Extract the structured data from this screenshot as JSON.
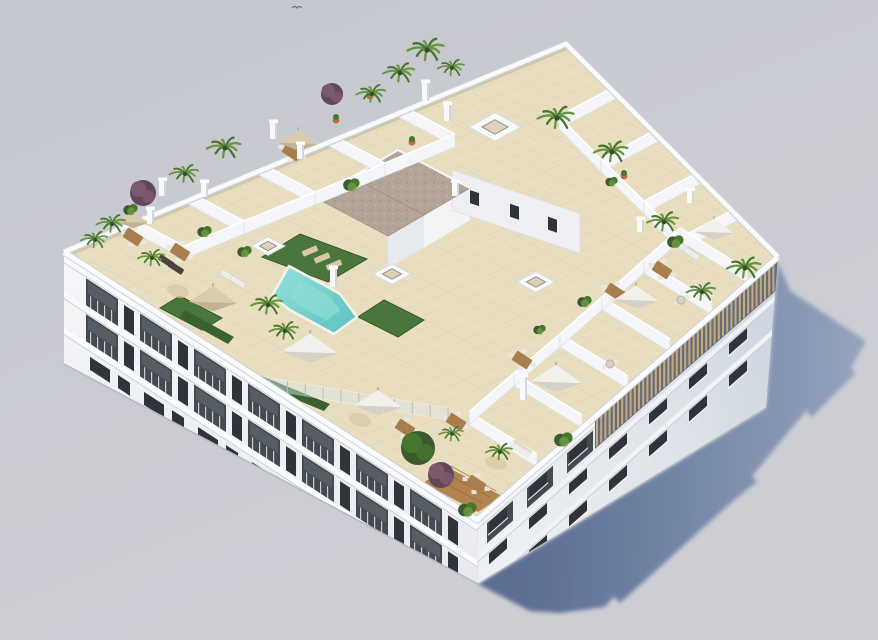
{
  "meta": {
    "alt": "Aerial 3D architectural rendering of a white apartment block with rooftop terraces, swimming pool, palm trees and parasols"
  },
  "palette": {
    "bg1": "#c5c7cf",
    "bg2": "#cdced4",
    "shadow1": "#57698f",
    "shadow2": "#7285a7",
    "shadow3": "#96a4bd",
    "facadeL1": "#f5f6f8",
    "facadeL2": "#e8eaee",
    "facadeR1": "#edeff2",
    "facadeR2": "#dde2e8",
    "facadeR3": "#ccd4de",
    "parapet": "#f9fafb",
    "parapetLine": "#ced2d8",
    "slab": "#fafbfd",
    "slabEdge": "#ced3d9",
    "windowDark": "#30343a",
    "balconyDark": "#454a52",
    "glassHint": "#5a6069",
    "mullion": "#c9ccd2",
    "roofTile": "#e9dec0",
    "tileLine": "rgba(120,100,60,0.18)",
    "pool1": "#5cc4c0",
    "pool2": "#8cdcd6",
    "poolEdge": "#f6f3ea",
    "lawn": "#49763a",
    "lawnStroke": "#35582b",
    "hedge": "#3a6130",
    "gravel": "#b2a597",
    "gravelDotA": "#a2958a",
    "gravelDotB": "#bfb3a6",
    "coreFace1": "#f1f3f5",
    "coreFace2": "#e6e9ed",
    "coreEdge": "#9a9084",
    "pergolaDark": "#59636f",
    "slat": "#c7a97e",
    "wood": "#a87e4e",
    "woodDeck": "#b08350",
    "plank": "#8a6238",
    "sofaWhite": "#eeece6",
    "sofaBack": "#dddbd2",
    "chairWhite": "#e9e7e0",
    "rugTan": "#d8c8a6",
    "tableTop": "#d8d2c4",
    "tableRing": "#b9b2a2",
    "umbWhite": "#f2f0ea",
    "umbWhiteShade": "#d6d1c6",
    "umbTan": "#d9cbad",
    "umbTanShade": "#c2b394",
    "palmDark": "#2e5226",
    "palmMid": "#47762f",
    "palmLight": "#68963f",
    "treeDark": "#3c5a30",
    "purple": "#7c5a6b",
    "purpleDark": "#64465a",
    "terracotta": "#b56f49",
    "glass": "#dce9ec",
    "glassPost": "#b8bec6",
    "pillarFront": "#f8f9fb",
    "pillarSide": "#d2d6db",
    "wallFill": "#f4f5f8",
    "wallEdge": "#d9dce1",
    "baseLine": "#b4b8c1",
    "bird": "#72757c",
    "loungerDark": "#4b4340"
  },
  "scene": {
    "roof": {
      "t": [
        566,
        44
      ],
      "l": [
        64,
        252
      ],
      "f": [
        477,
        520
      ],
      "r": [
        778,
        257
      ]
    },
    "facade_left": {
      "base_l": [
        64,
        364
      ],
      "base_f": [
        478,
        584
      ],
      "shear": 0.649,
      "len": 413,
      "cells": 7,
      "cell_step": 54,
      "cell_u0": 22
    },
    "facade_right": {
      "base_r": [
        766,
        408
      ],
      "shear": -0.874,
      "len": 301,
      "cols": 7,
      "col_step": 40,
      "col_u0": 12,
      "pergola_u0": 118
    },
    "shadow": [
      [
        478,
        584
      ],
      [
        766,
        408
      ],
      [
        778,
        262
      ],
      [
        790,
        291
      ],
      [
        866,
        341
      ],
      [
        851,
        368
      ],
      [
        856,
        373
      ],
      [
        812,
        417
      ],
      [
        806,
        411
      ],
      [
        752,
        476
      ],
      [
        757,
        482
      ],
      [
        734,
        500
      ],
      [
        620,
        603
      ],
      [
        614,
        597
      ],
      [
        604,
        607
      ],
      [
        560,
        613
      ],
      [
        530,
        611
      ]
    ],
    "pool": {
      "outline": [
        [
          289,
          266
        ],
        [
          326,
          286
        ],
        [
          340,
          294
        ],
        [
          357,
          317
        ],
        [
          334,
          334
        ],
        [
          290,
          310
        ],
        [
          272,
          296
        ]
      ],
      "inner_scale": 0.6
    },
    "lawns": [
      [
        [
          300,
          234
        ],
        [
          367,
          259
        ],
        [
          328,
          282
        ],
        [
          262,
          257
        ]
      ],
      [
        [
          384,
          300
        ],
        [
          424,
          320
        ],
        [
          398,
          337
        ],
        [
          358,
          317
        ]
      ],
      [
        [
          180,
          296
        ],
        [
          222,
          318
        ],
        [
          202,
          330
        ],
        [
          160,
          308
        ]
      ]
    ],
    "hedges": [
      [
        [
          185,
          310
        ],
        [
          234,
          337
        ],
        [
          228,
          344
        ],
        [
          179,
          317
        ]
      ],
      [
        [
          252,
          372
        ],
        [
          330,
          404
        ],
        [
          324,
          411
        ],
        [
          246,
          379
        ]
      ]
    ],
    "wood_deck": [
      [
        447,
        467
      ],
      [
        502,
        496
      ],
      [
        478,
        512
      ],
      [
        423,
        483
      ]
    ],
    "gravel": [
      [
        [
          398,
          150
        ],
        [
          470,
          188
        ],
        [
          424,
          215
        ],
        [
          352,
          177
        ]
      ],
      [
        [
          352,
          177
        ],
        [
          424,
          215
        ],
        [
          388,
          236
        ],
        [
          316,
          198
        ]
      ]
    ],
    "core": {
      "face1": [
        [
          470,
          188
        ],
        [
          424,
          215
        ],
        [
          424,
          248
        ],
        [
          470,
          220
        ]
      ],
      "face2": [
        [
          424,
          215
        ],
        [
          388,
          236
        ],
        [
          388,
          268
        ],
        [
          424,
          248
        ]
      ],
      "ext": {
        "o": [
          452,
          170
        ],
        "len": 128,
        "shear": 0.34,
        "h": 40,
        "windows": [
          18,
          58,
          96
        ]
      }
    },
    "skylights": [
      [
        495,
        127,
        26
      ],
      [
        268,
        246,
        17
      ],
      [
        392,
        274,
        19
      ],
      [
        536,
        282,
        19
      ]
    ],
    "pillars": [
      [
        150,
        224,
        15
      ],
      [
        204,
        197,
        15
      ],
      [
        273,
        139,
        17
      ],
      [
        300,
        159,
        15
      ],
      [
        425,
        101,
        19
      ],
      [
        447,
        121,
        17
      ],
      [
        640,
        232,
        13
      ],
      [
        690,
        203,
        13
      ],
      [
        333,
        287,
        19
      ],
      [
        523,
        400,
        24
      ],
      [
        162,
        196,
        16
      ],
      [
        455,
        196,
        14
      ]
    ],
    "walls": [
      [
        619,
        97,
        559,
        129
      ],
      [
        661,
        140,
        601,
        172
      ],
      [
        704,
        182,
        644,
        214
      ],
      [
        740,
        219,
        680,
        251
      ],
      [
        537,
        467,
        469,
        425
      ],
      [
        582,
        428,
        514,
        386
      ],
      [
        628,
        389,
        560,
        347
      ],
      [
        670,
        352,
        602,
        310
      ],
      [
        712,
        315,
        644,
        273
      ],
      [
        748,
        283,
        680,
        241
      ],
      [
        395,
        115,
        455,
        147
      ],
      [
        325,
        144,
        385,
        176
      ],
      [
        255,
        173,
        315,
        205
      ],
      [
        184,
        202,
        244,
        234
      ],
      [
        124,
        227,
        184,
        259
      ]
    ],
    "wall_lines": [
      [
        [
          559,
          129
        ],
        [
          601,
          172
        ],
        [
          644,
          214
        ],
        [
          680,
          251
        ]
      ],
      [
        [
          469,
          425
        ],
        [
          514,
          386
        ],
        [
          560,
          347
        ],
        [
          602,
          310
        ],
        [
          644,
          273
        ],
        [
          680,
          241
        ]
      ],
      [
        [
          455,
          147
        ],
        [
          385,
          176
        ],
        [
          315,
          205
        ],
        [
          244,
          234
        ],
        [
          184,
          259
        ]
      ]
    ],
    "glass_fence": {
      "a": [
        234,
        372
      ],
      "b": [
        448,
        408
      ],
      "h": 12,
      "posts": 12
    },
    "umbrellas": [
      [
        133,
        222,
        16,
        "tan"
      ],
      [
        213,
        302,
        24,
        "tan"
      ],
      [
        298,
        143,
        20,
        "tan"
      ],
      [
        310,
        352,
        28,
        "white"
      ],
      [
        378,
        406,
        24,
        "white"
      ],
      [
        556,
        382,
        26,
        "white"
      ],
      [
        636,
        300,
        22,
        "white"
      ],
      [
        714,
        232,
        20,
        "white"
      ]
    ],
    "tables": [
      [
        133,
        237
      ],
      [
        292,
        152
      ],
      [
        662,
        270
      ],
      [
        615,
        292
      ],
      [
        522,
        360
      ],
      [
        456,
        422
      ],
      [
        476,
        484
      ],
      [
        405,
        428
      ],
      [
        180,
        252
      ]
    ],
    "sofas": [
      [
        704,
        290
      ],
      [
        521,
        449
      ]
    ],
    "round_tables": [
      [
        681,
        300
      ],
      [
        610,
        364
      ]
    ],
    "rugs": [
      [
        178,
        291
      ],
      [
        496,
        463
      ],
      [
        360,
        420
      ]
    ],
    "loungers": [
      [
        310,
        251,
        1
      ],
      [
        322,
        258,
        1
      ],
      [
        334,
        265,
        1
      ],
      [
        228,
        276,
        0
      ],
      [
        238,
        282,
        0
      ],
      [
        684,
        248,
        0
      ],
      [
        692,
        254,
        0
      ],
      [
        166,
        261,
        2
      ],
      [
        176,
        268,
        2
      ]
    ],
    "palms": [
      [
        427,
        50,
        15
      ],
      [
        400,
        73,
        13
      ],
      [
        452,
        68,
        11
      ],
      [
        372,
        94,
        12
      ],
      [
        557,
        118,
        15
      ],
      [
        612,
        152,
        14
      ],
      [
        664,
        222,
        13
      ],
      [
        745,
        268,
        14
      ],
      [
        702,
        292,
        12
      ],
      [
        225,
        148,
        14
      ],
      [
        185,
        174,
        12
      ],
      [
        112,
        224,
        12
      ],
      [
        95,
        240,
        11
      ],
      [
        152,
        258,
        11
      ],
      [
        268,
        305,
        13
      ],
      [
        285,
        331,
        12
      ],
      [
        452,
        434,
        10
      ],
      [
        500,
        452,
        11
      ]
    ],
    "trees": [
      [
        418,
        448,
        17,
        "dark"
      ],
      [
        441,
        475,
        13,
        "purple"
      ],
      [
        143,
        193,
        13,
        "purple"
      ],
      [
        332,
        94,
        11,
        "purple"
      ]
    ],
    "bushes": [
      [
        352,
        185,
        8
      ],
      [
        564,
        440,
        9
      ],
      [
        468,
        510,
        9
      ],
      [
        205,
        232,
        7
      ],
      [
        245,
        252,
        7
      ],
      [
        676,
        242,
        8
      ],
      [
        585,
        302,
        7
      ],
      [
        540,
        330,
        6
      ],
      [
        131,
        210,
        7
      ],
      [
        612,
        182,
        6
      ]
    ],
    "pots": [
      [
        370,
        96
      ],
      [
        412,
        142
      ],
      [
        336,
        120
      ],
      [
        624,
        176
      ]
    ],
    "bird": [
      297,
      8
    ]
  }
}
